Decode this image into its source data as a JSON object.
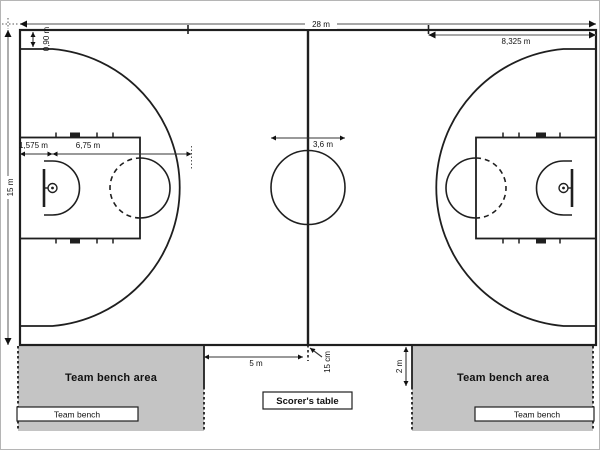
{
  "diagram_subject": "FIBA basketball court dimensions",
  "dimensions": {
    "court_length": "28 m",
    "court_width": "15 m",
    "throw_in_line_distance": "8,325 m",
    "three_point_sideline_offset": "0,90 m",
    "endline_to_basket": "1,575 m",
    "three_point_radius": "6,75 m",
    "centre_circle_diameter": "3,6 m",
    "bench_area_to_centre_line": "5 m",
    "centre_line_extension": "15 cm",
    "bench_boundary_length": "2 m"
  },
  "areas": {
    "left_bench_area_label": "Team bench area",
    "right_bench_area_label": "Team bench area",
    "left_bench_label": "Team bench",
    "right_bench_label": "Team bench",
    "scorers_table_label": "Scorer's table"
  },
  "colors": {
    "court_line": "#1f1f1f",
    "dimension_line": "#8a8a8a",
    "bench_fill": "#c4c4c4",
    "background": "#ffffff",
    "frame_border": "#b5b5b5"
  }
}
